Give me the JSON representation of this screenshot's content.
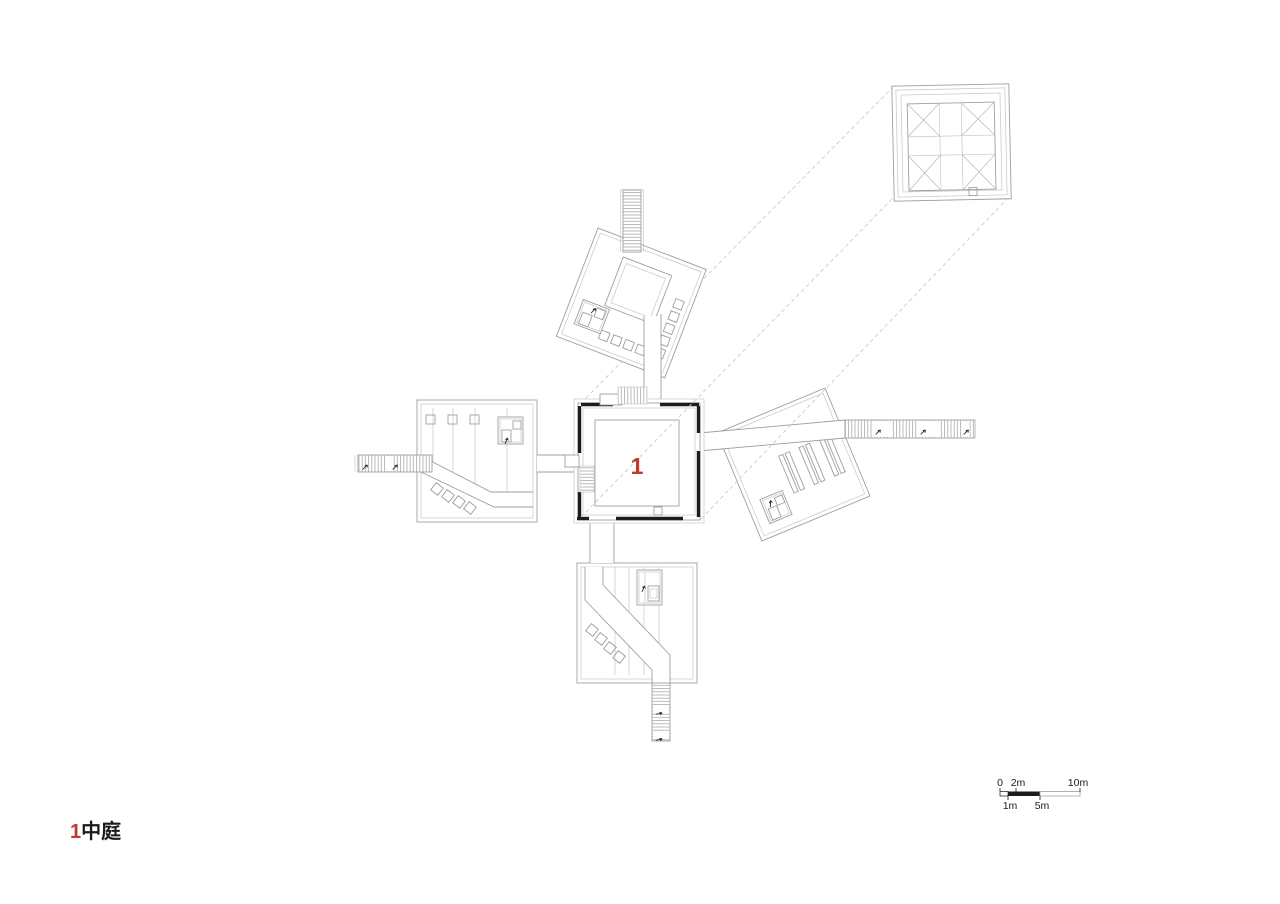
{
  "drawing": {
    "courtyard_label": "1",
    "legend": {
      "number": "1",
      "name": "中庭"
    },
    "scale_bar": {
      "zero": "0",
      "two": "2m",
      "ten": "10m",
      "one": "1m",
      "five": "5m"
    },
    "colors": {
      "accent": "#c0392b",
      "wall": "#1c1c1c",
      "line": "#9ba0a3",
      "line_light": "#c3c7c9",
      "dash": "#c9cccd"
    }
  }
}
